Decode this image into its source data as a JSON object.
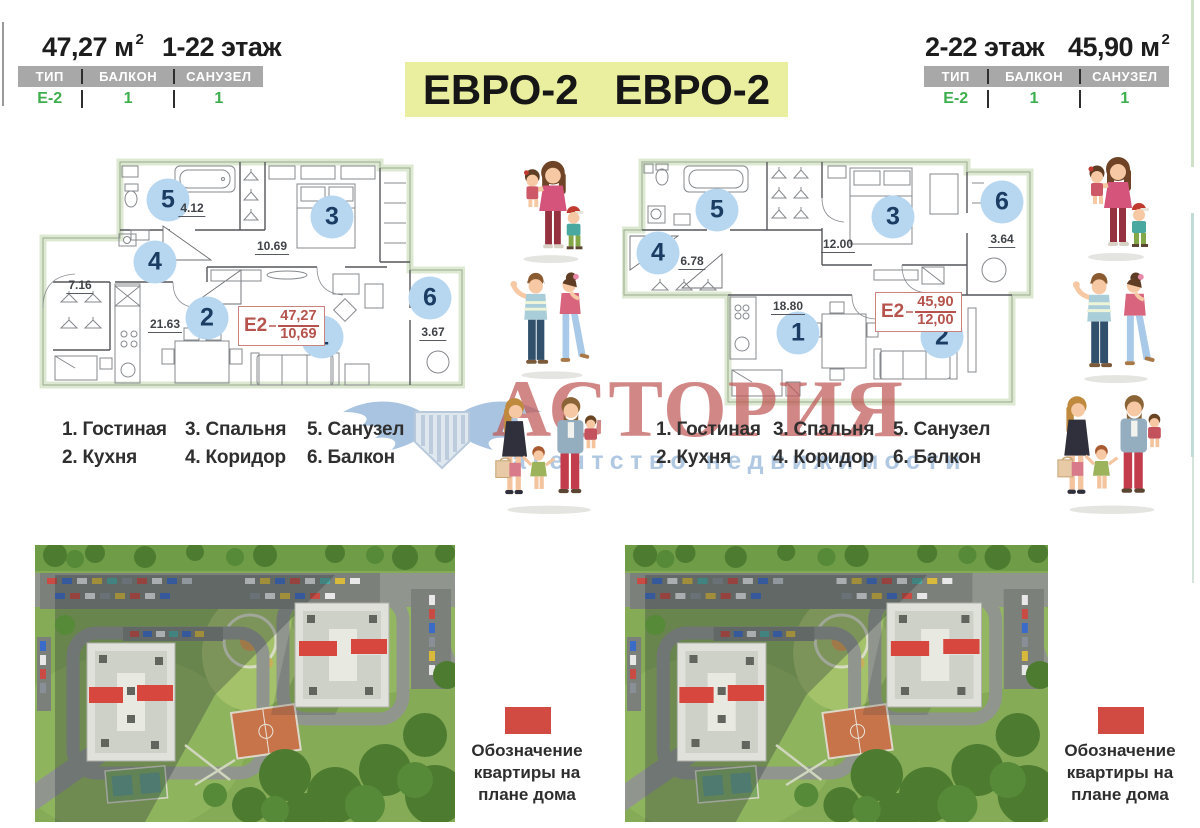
{
  "units": {
    "left": {
      "area": "47,27 м",
      "area_sup": "2",
      "floors": "1-22 этаж",
      "spec_headers": [
        "ТИП",
        "БАЛКОН",
        "САНУЗЕЛ"
      ],
      "spec_values": [
        "Е-2",
        "1",
        "1"
      ],
      "plan": {
        "c1": "1",
        "c2": "2",
        "c3": "3",
        "c4": "4",
        "c5": "5",
        "c6": "6",
        "dim_bathroom": "4.12",
        "dim_corridor": "7.16",
        "dim_bedroom": "10.69",
        "dim_kitchen": "21.63",
        "dim_balcony": "3.67",
        "tag_type": "Е2",
        "tag_area": "47,27",
        "tag_living": "10,69"
      }
    },
    "right": {
      "area": "45,90 м",
      "area_sup": "2",
      "floors": "2-22 этаж",
      "spec_headers": [
        "ТИП",
        "БАЛКОН",
        "САНУЗЕЛ"
      ],
      "spec_values": [
        "Е-2",
        "1",
        "1"
      ],
      "plan": {
        "c1": "1",
        "c2": "2",
        "c3": "3",
        "c4": "4",
        "c5": "5",
        "c6": "6",
        "dim_corridor": "6.78",
        "dim_bedroom": "12.00",
        "dim_kitchen": "18.80",
        "dim_balcony": "3.64",
        "tag_type": "Е2",
        "tag_area": "45,90",
        "tag_living": "12,00"
      }
    }
  },
  "title": {
    "badge1": "ЕВРО-2",
    "badge2": "ЕВРО-2"
  },
  "legend": {
    "items": [
      "1. Гостиная",
      "2. Кухня",
      "3. Спальня",
      "4. Коридор",
      "5. Санузел",
      "6. Балкон"
    ]
  },
  "watermark": {
    "brand": "АСТОРИЯ",
    "subtitle": "агентство недвижимости"
  },
  "map_legend": {
    "line1": "Обозначение",
    "line2": "квартиры на",
    "line3": "плане дома"
  },
  "colors": {
    "accent_green": "#3cae4c",
    "table_header_gray": "#a8a8a8",
    "title_bg": "#e9ef9e",
    "tag_red": "#b5534c",
    "mark_red": "#d8473d",
    "circle_blue": "#b7d7f1",
    "watermark_red": "#c05a57",
    "logo_blue": "#9fbedd"
  }
}
